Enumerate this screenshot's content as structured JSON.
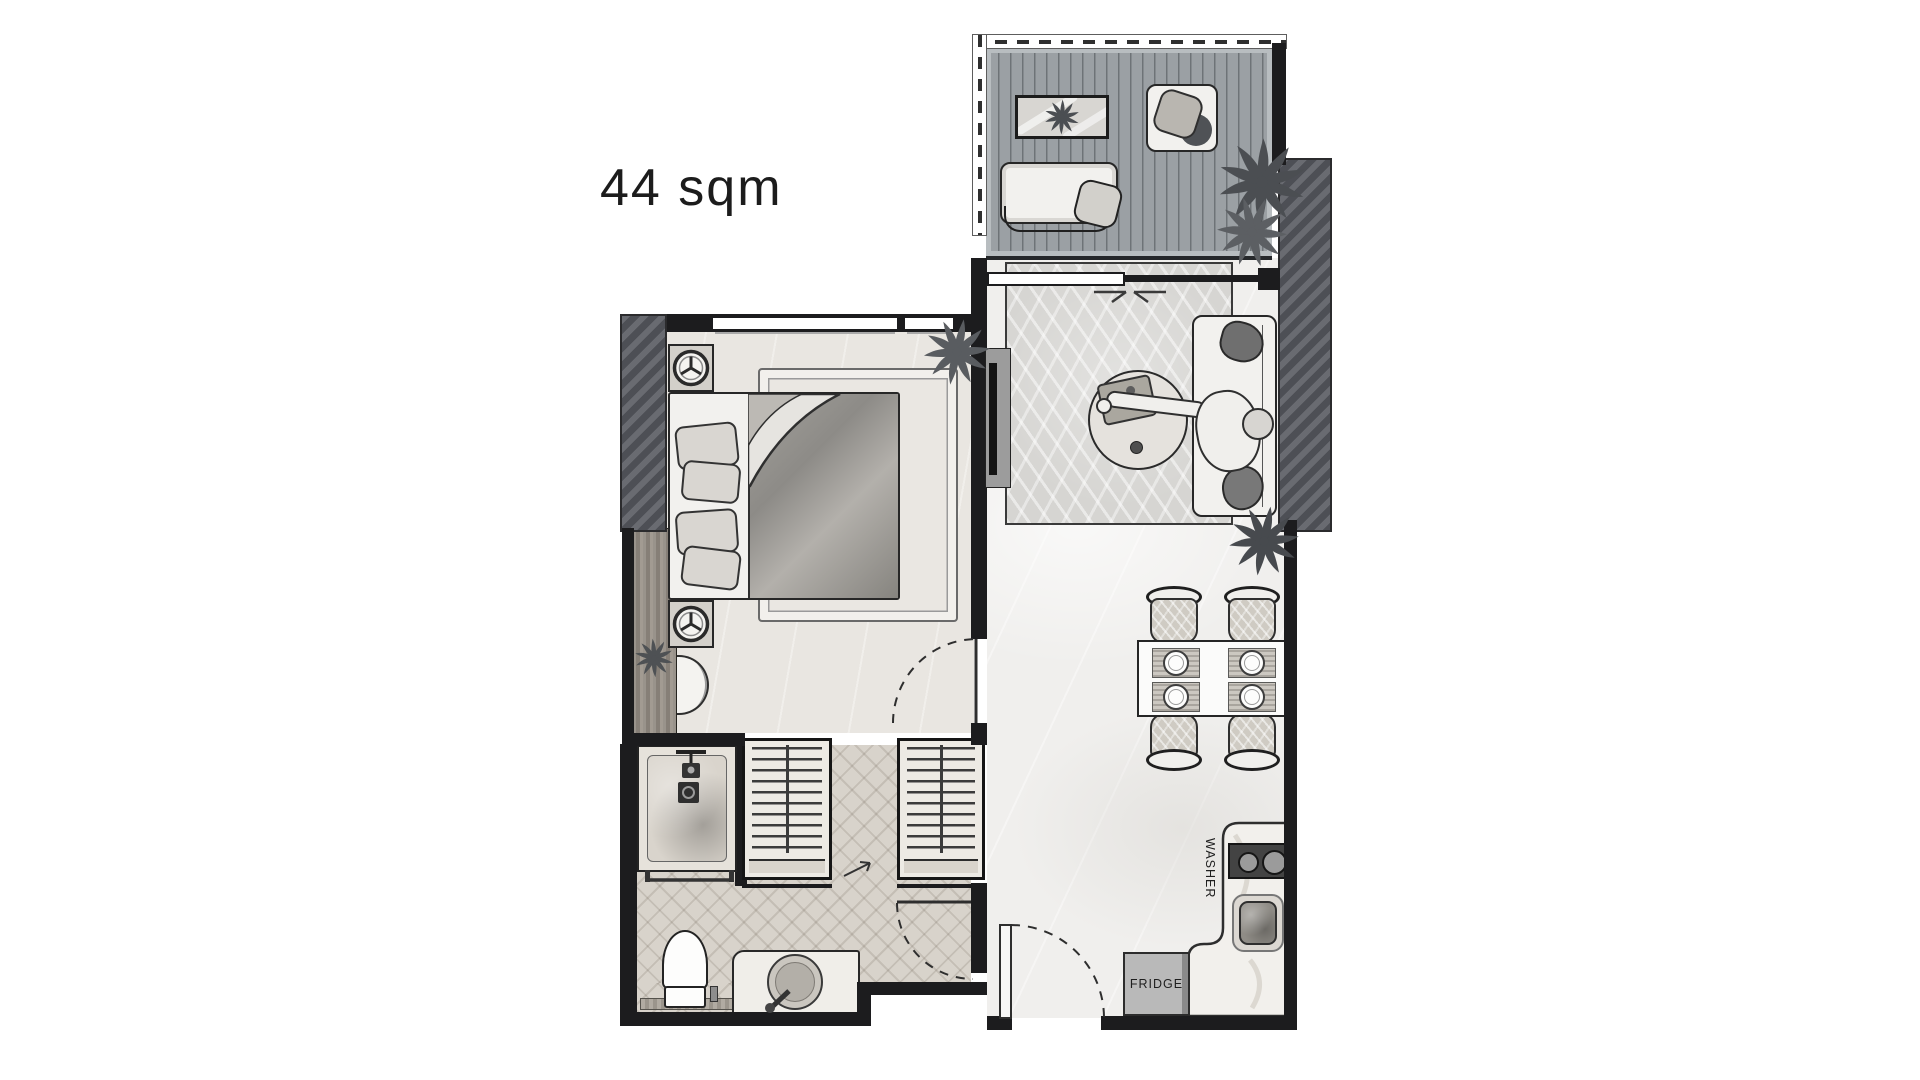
{
  "plan": {
    "area_label": "44 sqm",
    "kitchen": {
      "washer_label": "WASHER",
      "fridge_label": "FRIDGE"
    },
    "rooms": [
      "balcony",
      "living-dining",
      "bedroom",
      "bathroom",
      "wardrobe-hall",
      "kitchen",
      "entrance"
    ],
    "furniture_icons": [
      "deck-table-icon",
      "deck-daybed-icon",
      "deck-armchair-icon",
      "potted-plant-icon",
      "sliding-door-icon",
      "sofa-icon",
      "person-figure-icon",
      "round-coffee-table-icon",
      "tv-unit-icon",
      "palm-rug-icon",
      "dining-table-icon",
      "dining-chair-icon",
      "placemat-plate-icon",
      "kitchen-counter-icon",
      "washer-hob-icon",
      "kitchen-sink-icon",
      "fridge-icon",
      "entrance-door-swing-icon",
      "double-bed-icon",
      "pillow-icon",
      "duvet-fold-icon",
      "nightstand-lamp-icon",
      "wardrobe-hangers-icon",
      "shower-icon",
      "shower-drain-icon",
      "towel-rail-icon",
      "toilet-icon",
      "vanity-basin-icon",
      "faucet-icon",
      "demilune-console-icon",
      "window-icon",
      "door-swing-icon",
      "railing-icon"
    ],
    "colors": {
      "wall": "#1c1c1e",
      "hatch_wall": "#56585e",
      "deck": "#9ba0a4",
      "floor_living": "#f0efed",
      "floor_bedroom": "#e9e6e1",
      "floor_bath": "#d8d3cb",
      "rug": "#d6d5d2",
      "furniture_light": "#f2f1ee",
      "plant_dark": "#4b4e52",
      "appliance_dark": "#434343",
      "text": "#1c1c1c"
    }
  }
}
